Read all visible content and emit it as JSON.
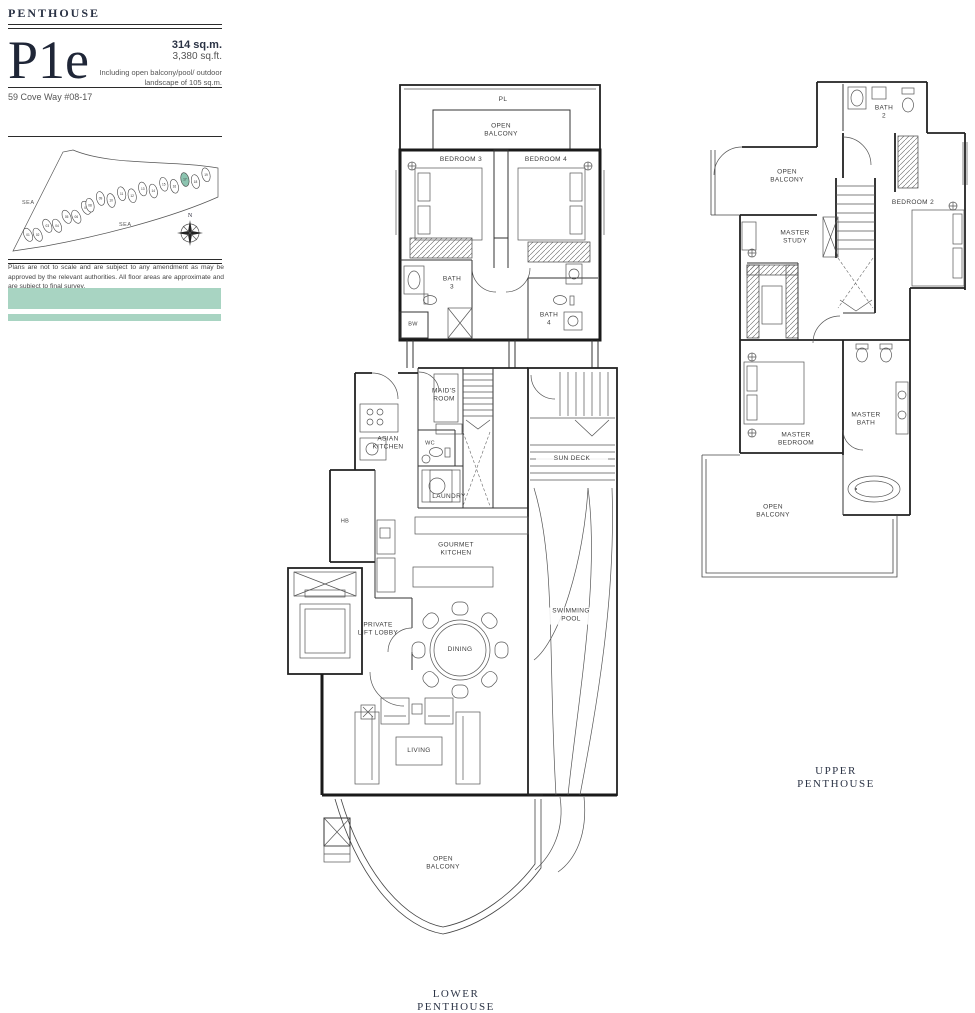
{
  "header": {
    "category": "PENTHOUSE",
    "unit_code": "P1e",
    "area_metric": "314 sq.m.",
    "area_imperial": "3,380 sq.ft.",
    "area_note": "Including open balcony/pool/ outdoor landscape of 105 sq.m.",
    "address": "59 Cove Way #08-17"
  },
  "site_map": {
    "sea_left": "SEA",
    "sea_bottom": "SEA",
    "compass_label": "N",
    "stacks": [
      "01",
      "02",
      "03",
      "04",
      "05",
      "06",
      "07",
      "08",
      "09",
      "10",
      "11",
      "12",
      "13",
      "14",
      "15",
      "16",
      "17",
      "18",
      "19"
    ],
    "highlighted_stack": "17"
  },
  "disclaimer": "Plans are not to scale and are subject to any amendment as may be approved by the relevant authorities. All floor areas are approximate and are subject to final survey.",
  "accents": {
    "teal_band": "#a8d4c2",
    "map_highlight": "#8cc4b0"
  },
  "plans": {
    "lower": {
      "title": "LOWER PENTHOUSE",
      "rooms": {
        "pl": "PL",
        "open_balcony_top": "OPEN BALCONY",
        "bedroom3": "BEDROOM 3",
        "bedroom4": "BEDROOM 4",
        "bath3": "BATH 3",
        "bath4": "BATH 4",
        "bw": "BW",
        "maids_room": "MAID'S ROOM",
        "wc": "WC",
        "asian_kitchen": "ASIAN KITCHEN",
        "laundry": "LAUNDRY",
        "hb": "HB",
        "sun_deck": "SUN DECK",
        "gourmet_kitchen": "GOURMET KITCHEN",
        "swimming_pool": "SWIMMING POOL",
        "private_lift_lobby": "PRIVATE LIFT LOBBY",
        "dining": "DINING",
        "living": "LIVING",
        "open_balcony_bottom": "OPEN BALCONY"
      }
    },
    "upper": {
      "title": "UPPER PENTHOUSE",
      "rooms": {
        "bath2": "BATH 2",
        "open_balcony_top": "OPEN BALCONY",
        "bedroom2": "BEDROOM 2",
        "master_study": "MASTER STUDY",
        "master_bedroom": "MASTER BEDROOM",
        "master_bath": "MASTER BATH",
        "open_balcony_bottom": "OPEN BALCONY"
      }
    }
  }
}
